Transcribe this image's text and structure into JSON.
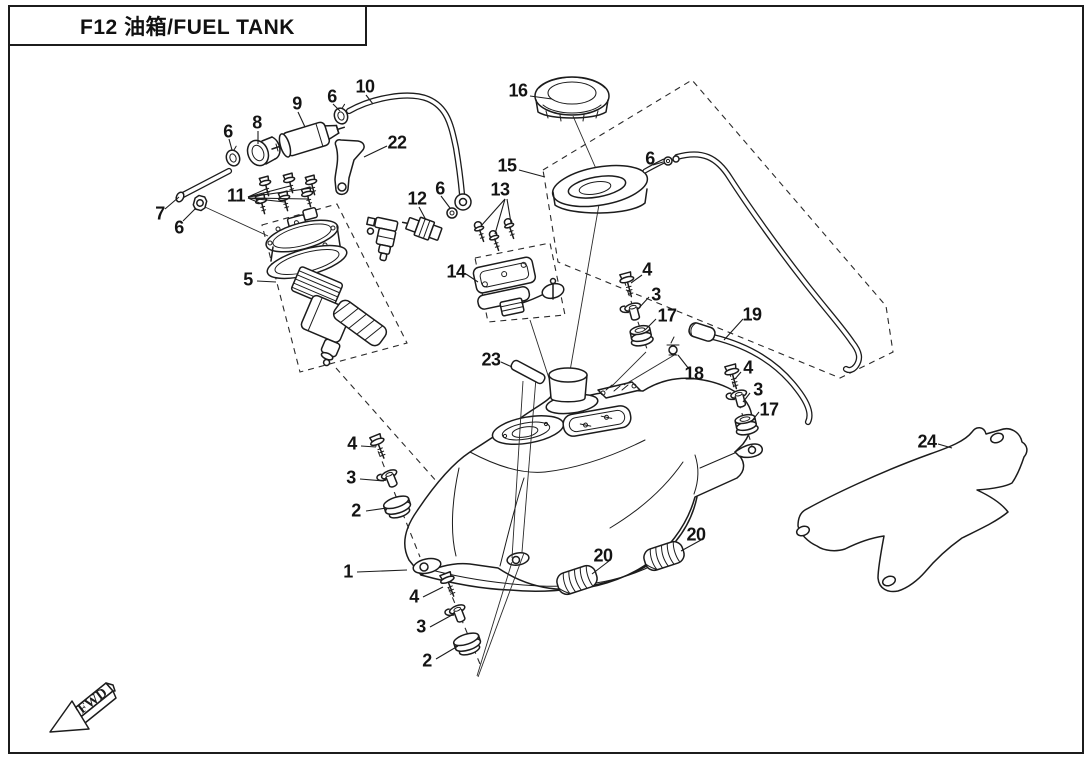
{
  "title": {
    "label": "F12 油箱/FUEL TANK"
  },
  "direction_indicator": {
    "label": "FWD"
  },
  "colors": {
    "line": "#1c1c1c",
    "background": "#ffffff"
  },
  "callouts": [
    {
      "n": "16",
      "x": 518,
      "y": 91
    },
    {
      "n": "10",
      "x": 365,
      "y": 87
    },
    {
      "n": "6",
      "x": 332,
      "y": 97
    },
    {
      "n": "9",
      "x": 297,
      "y": 104
    },
    {
      "n": "8",
      "x": 257,
      "y": 123
    },
    {
      "n": "6",
      "x": 228,
      "y": 132
    },
    {
      "n": "22",
      "x": 397,
      "y": 143
    },
    {
      "n": "15",
      "x": 507,
      "y": 166
    },
    {
      "n": "6",
      "x": 650,
      "y": 159
    },
    {
      "n": "13",
      "x": 500,
      "y": 190
    },
    {
      "n": "11",
      "x": 236,
      "y": 196
    },
    {
      "n": "12",
      "x": 417,
      "y": 199
    },
    {
      "n": "6",
      "x": 440,
      "y": 189
    },
    {
      "n": "7",
      "x": 160,
      "y": 214
    },
    {
      "n": "6",
      "x": 179,
      "y": 228
    },
    {
      "n": "5",
      "x": 248,
      "y": 280
    },
    {
      "n": "14",
      "x": 456,
      "y": 272
    },
    {
      "n": "4",
      "x": 647,
      "y": 270
    },
    {
      "n": "3",
      "x": 656,
      "y": 295
    },
    {
      "n": "17",
      "x": 667,
      "y": 316
    },
    {
      "n": "19",
      "x": 752,
      "y": 315
    },
    {
      "n": "18",
      "x": 694,
      "y": 374
    },
    {
      "n": "4",
      "x": 748,
      "y": 368
    },
    {
      "n": "3",
      "x": 758,
      "y": 390
    },
    {
      "n": "17",
      "x": 769,
      "y": 410
    },
    {
      "n": "23",
      "x": 491,
      "y": 360
    },
    {
      "n": "24",
      "x": 927,
      "y": 442
    },
    {
      "n": "4",
      "x": 352,
      "y": 444
    },
    {
      "n": "3",
      "x": 351,
      "y": 478
    },
    {
      "n": "2",
      "x": 356,
      "y": 511
    },
    {
      "n": "1",
      "x": 348,
      "y": 572
    },
    {
      "n": "4",
      "x": 414,
      "y": 597
    },
    {
      "n": "3",
      "x": 421,
      "y": 627
    },
    {
      "n": "2",
      "x": 427,
      "y": 661
    },
    {
      "n": "20",
      "x": 603,
      "y": 556
    },
    {
      "n": "20",
      "x": 696,
      "y": 535
    }
  ]
}
